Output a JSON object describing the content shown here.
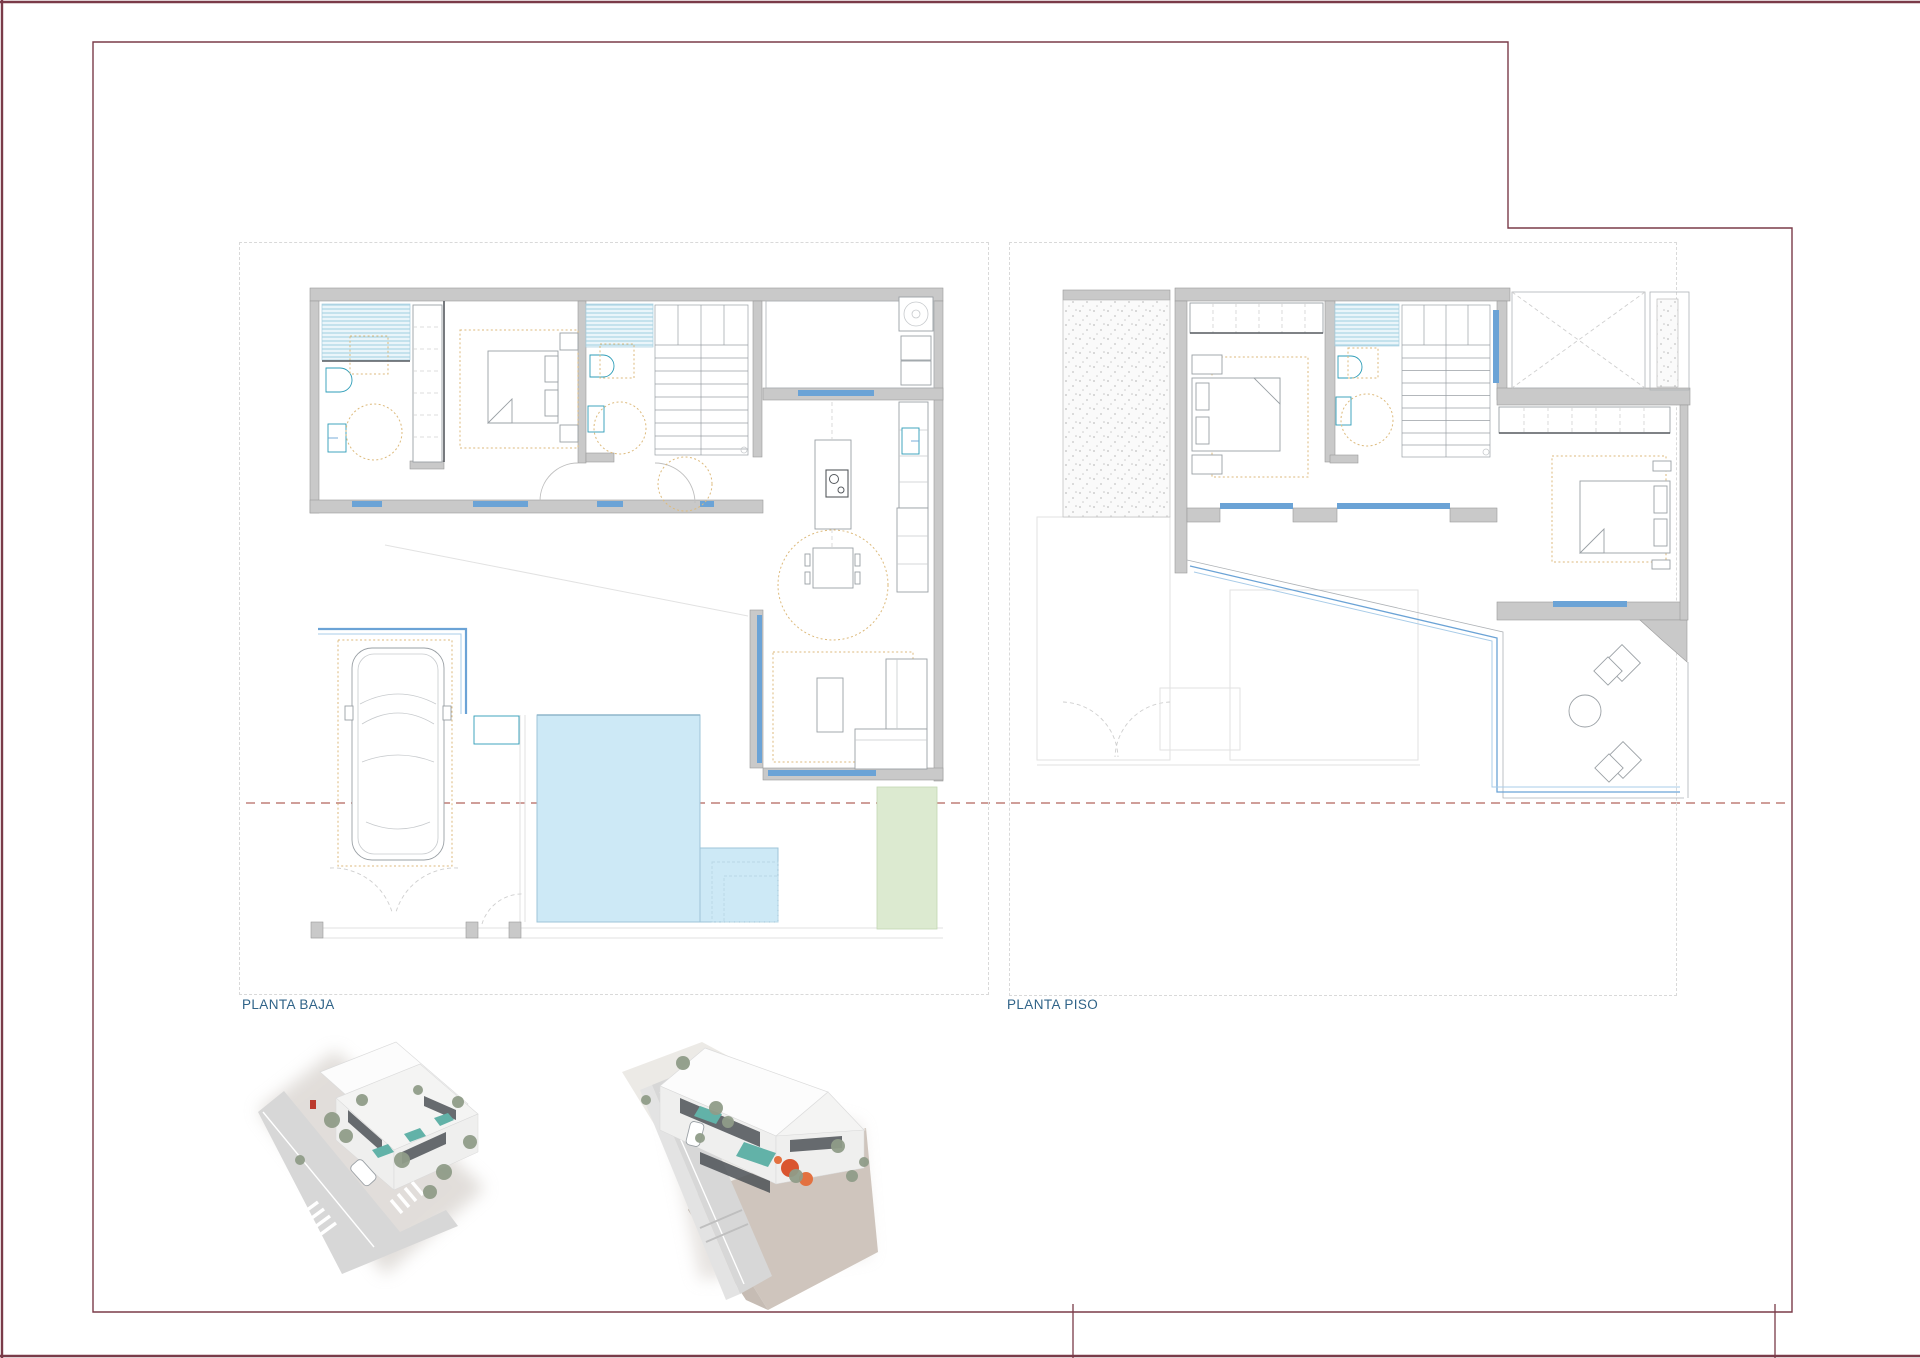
{
  "palette": {
    "frame-red": "#7a3b49",
    "panel-dash": "#d9d9d9",
    "label-teal": "#2f6388",
    "wall-gray": "#c9c9c9",
    "wall-edge": "#9b9b9b",
    "window-blue": "#6ba3d6",
    "shower-blue": "#9fcfe0",
    "pool-fill": "#cde9f6",
    "pool-edge": "#9ec4d8",
    "garden-green": "#dcead0",
    "furniture-orange": "#ddba7c",
    "section-red": "#b2645c",
    "render-pool": "#5fb3a8",
    "render-accent": "#e0542c",
    "render-tree": "#8f9c87",
    "render-window": "#4d5257"
  },
  "plans": [
    {
      "label": "PLANTA BAJA"
    },
    {
      "label": "PLANTA PISO"
    }
  ]
}
